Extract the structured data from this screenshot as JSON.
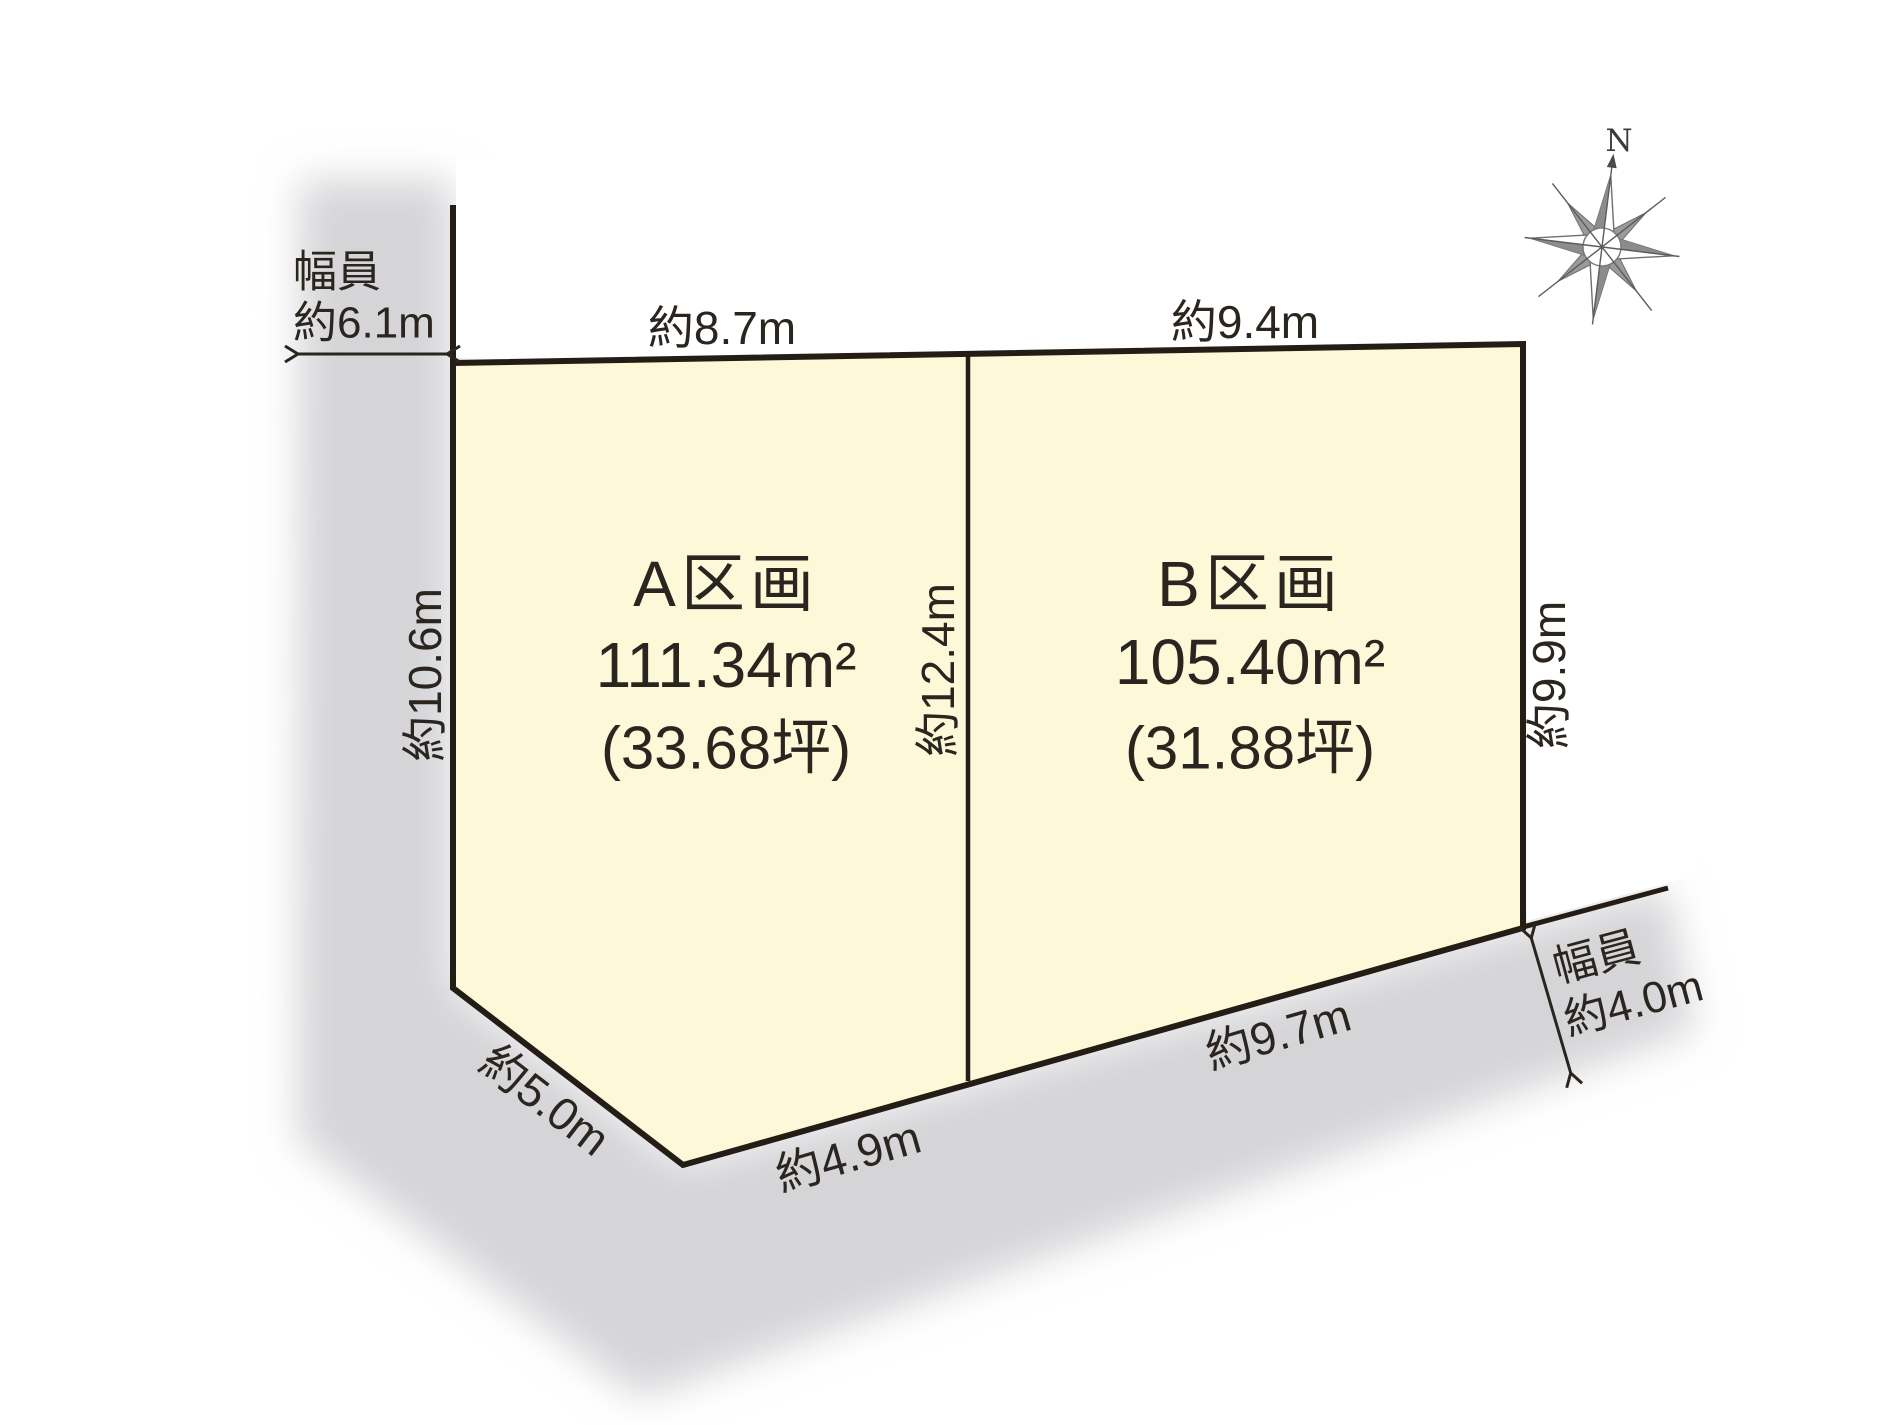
{
  "compass": {
    "north_label": "N"
  },
  "roads": {
    "left": {
      "label_line1": "幅員",
      "label_line2": "約6.1m"
    },
    "bottom": {
      "label_line1": "幅員",
      "label_line2": "約4.0m"
    }
  },
  "parcels": [
    {
      "name": "A区画",
      "area_sqm": "111.34m²",
      "area_tsubo": "(33.68坪)"
    },
    {
      "name": "B区画",
      "area_sqm": "105.40m²",
      "area_tsubo": "(31.88坪)"
    }
  ],
  "dimensions": {
    "parcel_a_top": "約8.7m",
    "parcel_b_top": "約9.4m",
    "left_side": "約10.6m",
    "divider": "約12.4m",
    "right_side": "約9.9m",
    "diagonal": "約5.0m",
    "parcel_a_bottom": "約4.9m",
    "parcel_b_bottom": "約9.7m"
  },
  "colors": {
    "parcel_fill": "#fcf8d8",
    "road_fill": "#d5d5d8",
    "line": "#241d15",
    "text": "#2b2520",
    "compass_gray": "#8c8c8c"
  }
}
